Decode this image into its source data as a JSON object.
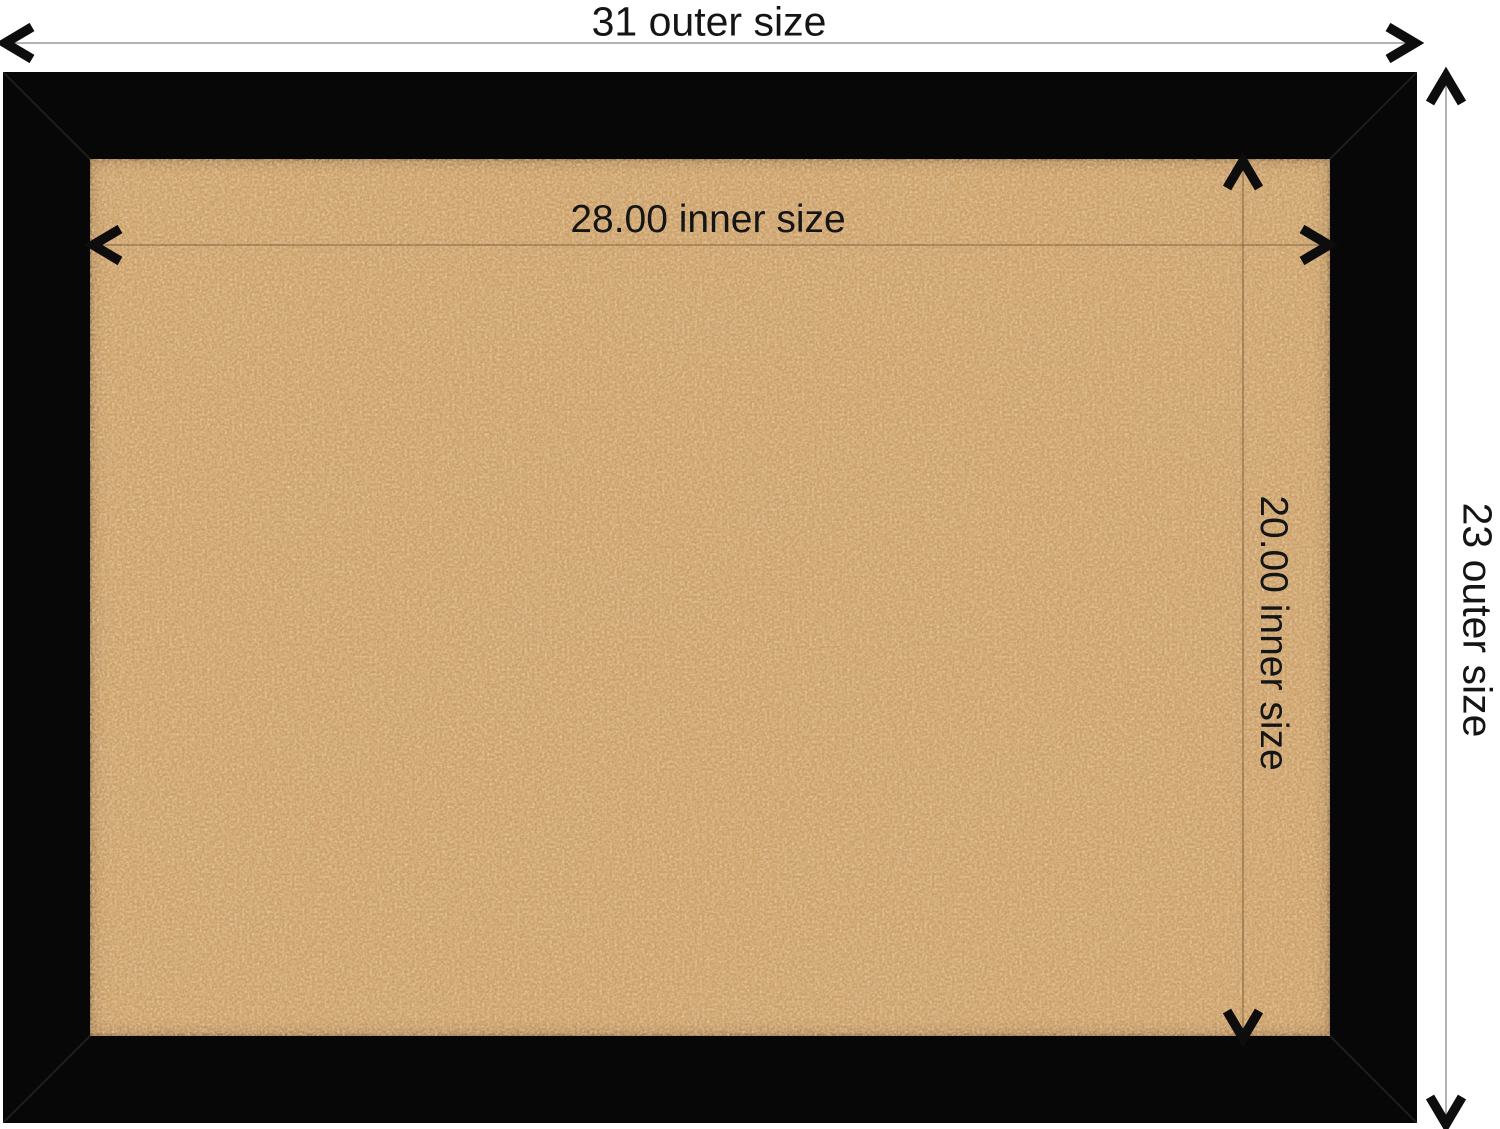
{
  "labels": {
    "outer_width": "31 outer size",
    "outer_height": "23 outer size",
    "inner_width": "28.00 inner size",
    "inner_height": "20.00 inner size"
  },
  "colors": {
    "background": "#ffffff",
    "frame": "#070707",
    "cork_base": "#cb9c63",
    "cork_dark_speckle": "#a36b33",
    "cork_light_speckle": "#eccb98",
    "outer_dimension_line": "#9a9a9a",
    "inner_dimension_line": "#7a6147",
    "arrow": "#0d0d0d",
    "label_text": "#151515"
  }
}
